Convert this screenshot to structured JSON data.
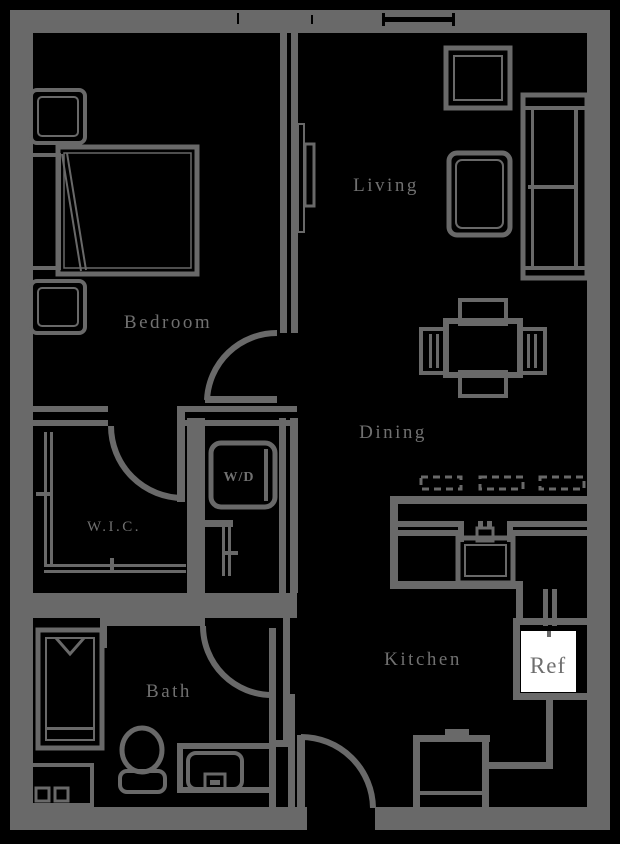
{
  "floorplan": {
    "labels": {
      "bedroom": "Bedroom",
      "living": "Living",
      "dining": "Dining",
      "kitchen": "Kitchen",
      "wic": "W.I.C.",
      "wd": "W/D",
      "bath": "Bath",
      "ref": "Ref"
    },
    "colors": {
      "background": "#000000",
      "wall": "#696969",
      "label": "#707070",
      "window_line": "#000000",
      "ref_fill": "#ffffff",
      "ref_text": "#6e6e6e"
    }
  }
}
